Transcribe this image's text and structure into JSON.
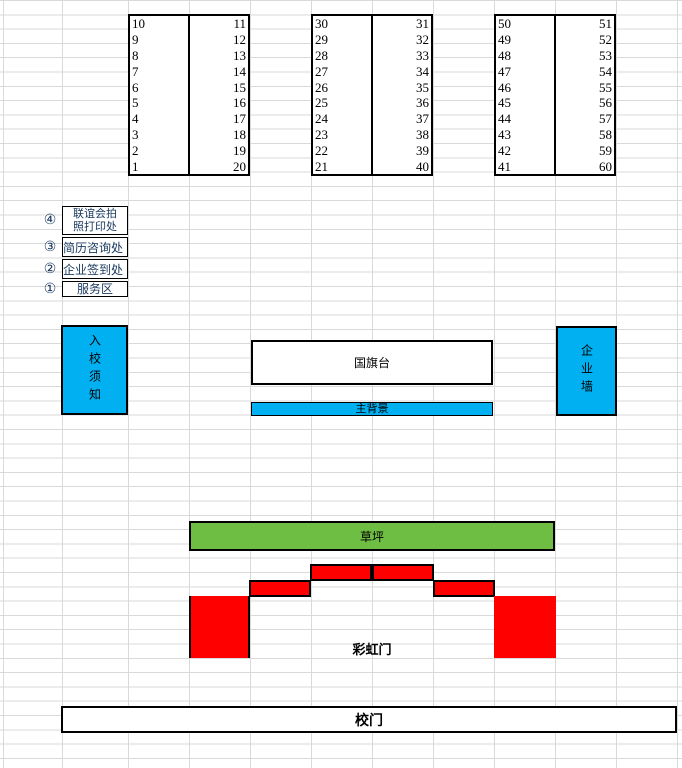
{
  "sheet": {
    "booth_tables": [
      {
        "left": [
          "10",
          "9",
          "8",
          "7",
          "6",
          "5",
          "4",
          "3",
          "2",
          "1"
        ],
        "right": [
          "11",
          "12",
          "13",
          "14",
          "15",
          "16",
          "17",
          "18",
          "19",
          "20"
        ]
      },
      {
        "left": [
          "30",
          "29",
          "28",
          "27",
          "26",
          "25",
          "24",
          "23",
          "22",
          "21"
        ],
        "right": [
          "31",
          "32",
          "33",
          "34",
          "35",
          "36",
          "37",
          "38",
          "39",
          "40"
        ]
      },
      {
        "left": [
          "50",
          "49",
          "48",
          "47",
          "46",
          "45",
          "44",
          "43",
          "42",
          "41"
        ],
        "right": [
          "51",
          "52",
          "53",
          "54",
          "55",
          "56",
          "57",
          "58",
          "59",
          "60"
        ]
      }
    ],
    "service_points": [
      {
        "marker": "④",
        "line1": "联谊会拍",
        "line2": "照打印处"
      },
      {
        "marker": "③",
        "line1": "简历咨询处"
      },
      {
        "marker": "②",
        "line1": "企业签到处"
      },
      {
        "marker": "①",
        "line1": "服务区"
      }
    ],
    "zones": {
      "entry_notice": "入校须知",
      "flag_stage": "国旗台",
      "main_backdrop": "主背景",
      "company_wall": "企业墙",
      "lawn": "草坪",
      "rainbow_gate": "彩虹门",
      "school_gate": "校门"
    },
    "colors": {
      "cyan": "#00B0F0",
      "green": "#6FBE44",
      "red": "#FF0000",
      "label_text": "#17375D",
      "gridline": "#D9D9D9"
    }
  }
}
